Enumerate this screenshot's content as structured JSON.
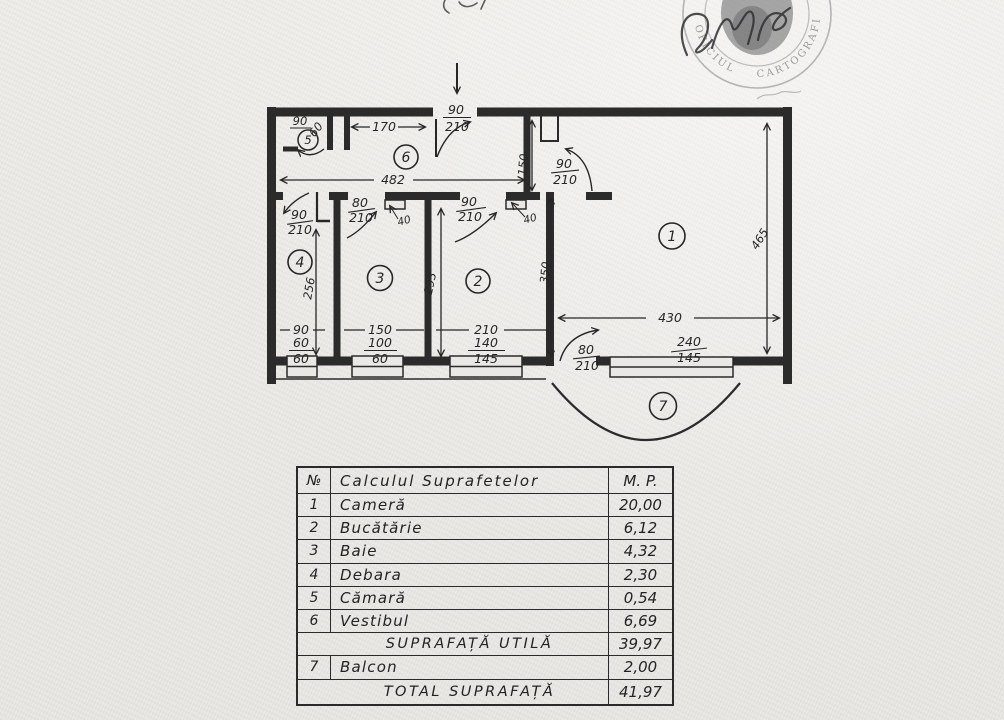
{
  "stamp": {
    "arc_left": "OFICIUL",
    "arc_right": "CARTOGRAFIE"
  },
  "plan": {
    "rooms": {
      "r1": "1",
      "r2": "2",
      "r3": "3",
      "r4": "4",
      "r5": "5",
      "r6": "6",
      "r7": "7"
    },
    "dims": {
      "overall": "482",
      "hall": "170",
      "nook": "150",
      "r1w": "430",
      "r1h": "465",
      "r1inner": "350",
      "r2d": "293",
      "r4d": "256",
      "jamb40a": "40",
      "jamb40b": "40"
    },
    "pantry_width": "90",
    "doors": {
      "entry_w": "90",
      "entry_h": "210",
      "r1_w": "90",
      "r1_h": "210",
      "r4_w": "90",
      "r4_h": "210",
      "r3_w": "80",
      "r3_h": "210",
      "r2_w": "90",
      "r2_h": "210",
      "balc_w": "80",
      "balc_h": "210",
      "pantry_w": "60"
    },
    "windows": {
      "r4": {
        "a": "90",
        "b": "60",
        "c": "60"
      },
      "r3": {
        "a": "150",
        "b": "100",
        "c": "60"
      },
      "r2": {
        "a": "210",
        "b": "140",
        "c": "145"
      },
      "r1": {
        "a": "240",
        "b": "145"
      }
    }
  },
  "table": {
    "header": {
      "num": "№",
      "title": "Calculul  Suprafetelor",
      "unit": "M. P."
    },
    "rows": [
      {
        "num": "1",
        "name": "Cameră",
        "value": "20,00"
      },
      {
        "num": "2",
        "name": "Bucătărie",
        "value": "6,12"
      },
      {
        "num": "3",
        "name": "Baie",
        "value": "4,32"
      },
      {
        "num": "4",
        "name": "Debara",
        "value": "2,30"
      },
      {
        "num": "5",
        "name": "Cămară",
        "value": "0,54"
      },
      {
        "num": "6",
        "name": "Vestibul",
        "value": "6,69"
      },
      {
        "num": "",
        "name": "SUPRAFAȚĂ  UTILĂ",
        "value": "39,97"
      },
      {
        "num": "7",
        "name": "Balcon",
        "value": "2,00"
      },
      {
        "num": "",
        "name": "TOTAL  SUPRAFAȚĂ",
        "value": "41,97"
      }
    ]
  }
}
